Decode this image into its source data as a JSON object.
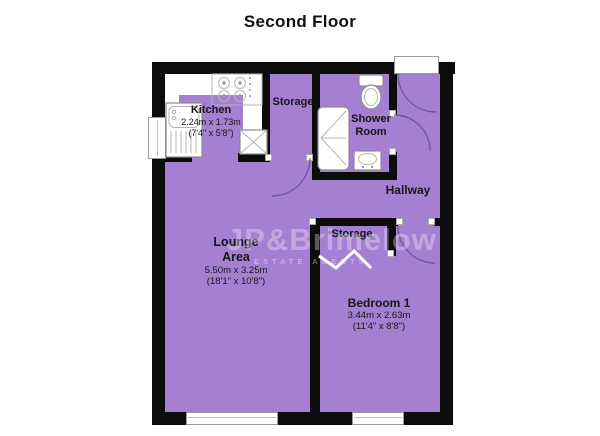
{
  "title": "Second Floor",
  "watermark": {
    "brand": "JP&Brimelow",
    "tagline": "ESTATE AGENTS"
  },
  "rooms": {
    "kitchen": {
      "name": "Kitchen",
      "metric": "2.24m x 1.73m",
      "imperial": "(7'4\" x 5'8\")"
    },
    "storage_top": {
      "name": "Storage"
    },
    "shower_room": {
      "line1": "Shower",
      "line2": "Room"
    },
    "hallway": {
      "name": "Hallway"
    },
    "lounge": {
      "line1": "Lounge",
      "line2": "Area",
      "metric": "5.50m x 3.25m",
      "imperial": "(18'1\" x 10'8\")"
    },
    "storage_mid": {
      "name": "Storage"
    },
    "bedroom": {
      "name": "Bedroom 1",
      "metric": "3.44m x 2.63m",
      "imperial": "(11'4\" x 8'8\")"
    }
  },
  "fixtures": [
    "sink-drainer-unit",
    "cooker-hob",
    "cupboard",
    "shower-tray",
    "toilet",
    "wash-basin"
  ],
  "openings": [
    "entrance-door",
    "shower-room-door",
    "storage-door",
    "bedroom-door"
  ],
  "windows_count": 3,
  "colors": {
    "floor": "#A57FD2",
    "wall": "#0C0C0C",
    "arc": "#5F4B85",
    "stroke": "#8C8C8C"
  }
}
